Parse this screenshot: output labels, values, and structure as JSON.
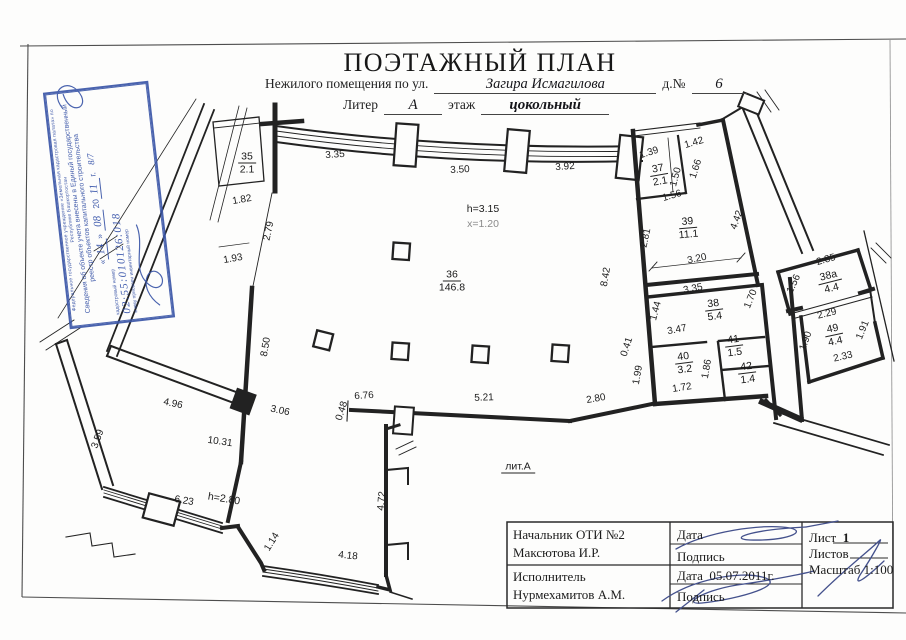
{
  "header": {
    "title": "ПОЭТАЖНЫЙ ПЛАН",
    "subtitle_prefix": "Нежилого помещения по ул.",
    "street": "Загира Исмагилова",
    "house_label": "д.№",
    "house_number": "6",
    "liter_label": "Литер",
    "liter_value": "А",
    "floor_label": "этаж",
    "floor_value": "цокольный"
  },
  "stamp": {
    "org": "Федеральное государственное учреждение «Земельная кадастровая палата» по Республике Башкортостан",
    "body": "Сведения об объекте учета внесены в Единый государственный реестр объектов капитального строительства",
    "quote_open": "«",
    "quote_close": "»",
    "day": "14",
    "month": "08",
    "year_prefix": "20",
    "year": "11",
    "year_suffix": "г.",
    "fraction": "8/7",
    "cadastral_label": "кадастровый номер",
    "cadastral_number": "02:55:010126:018",
    "inventory_label": "и ему присвоен инвентарный номер"
  },
  "plan": {
    "notes": {
      "height": "h=3.15",
      "level": "x=1.20",
      "height2": "h=2.80",
      "liter": "лит.А"
    },
    "rooms": [
      {
        "num": "35",
        "area": "2.1"
      },
      {
        "num": "36",
        "area": "146.8"
      },
      {
        "num": "37",
        "area": "2.1"
      },
      {
        "num": "39",
        "area": "11.1"
      },
      {
        "num": "38",
        "area": "5.4"
      },
      {
        "num": "38а",
        "area": "4.4"
      },
      {
        "num": "40",
        "area": "3.2"
      },
      {
        "num": "41",
        "area": "1.5"
      },
      {
        "num": "42",
        "area": "1.4"
      },
      {
        "num": "49",
        "area": "4.4"
      }
    ],
    "dims": [
      {
        "t": "3.35"
      },
      {
        "t": "3.50"
      },
      {
        "t": "3.92"
      },
      {
        "t": "1.82"
      },
      {
        "t": "2.79"
      },
      {
        "t": "1.93"
      },
      {
        "t": "8.42"
      },
      {
        "t": "1.39"
      },
      {
        "t": "1.42"
      },
      {
        "t": "1.50"
      },
      {
        "t": "1.66"
      },
      {
        "t": "1.56"
      },
      {
        "t": "2.81"
      },
      {
        "t": "4.42"
      },
      {
        "t": "3.20"
      },
      {
        "t": "3.35"
      },
      {
        "t": "2.85"
      },
      {
        "t": "1.56"
      },
      {
        "t": "2.29"
      },
      {
        "t": "1.90"
      },
      {
        "t": "1.91"
      },
      {
        "t": "2.33"
      },
      {
        "t": "1.44"
      },
      {
        "t": "3.47"
      },
      {
        "t": "1.70"
      },
      {
        "t": "1.86"
      },
      {
        "t": "1.72"
      },
      {
        "t": "0.41"
      },
      {
        "t": "1.99"
      },
      {
        "t": "6.76"
      },
      {
        "t": "0.48"
      },
      {
        "t": "5.21"
      },
      {
        "t": "2.80"
      },
      {
        "t": "4.96"
      },
      {
        "t": "3.06"
      },
      {
        "t": "10.31"
      },
      {
        "t": "3.59"
      },
      {
        "t": "8.50"
      },
      {
        "t": "6.23"
      },
      {
        "t": "1.14"
      },
      {
        "t": "4.18"
      },
      {
        "t": "4.72"
      }
    ]
  },
  "titleblock": {
    "chief_title": "Начальник ОТИ №2",
    "chief_name": "Максютова И.Р.",
    "date_label": "Дата",
    "sign_label": "Подпись",
    "executor_title": "Исполнитель",
    "executor_name": "Нурмехамитов А.М.",
    "date_label2": "Дата",
    "date_value": "05.07.2011г.",
    "sign_label2": "Подпись",
    "sheet_label": "Лист",
    "sheet_value": "1",
    "sheets_label": "Листов",
    "scale_label": "Масштаб",
    "scale_value": "1:100"
  }
}
